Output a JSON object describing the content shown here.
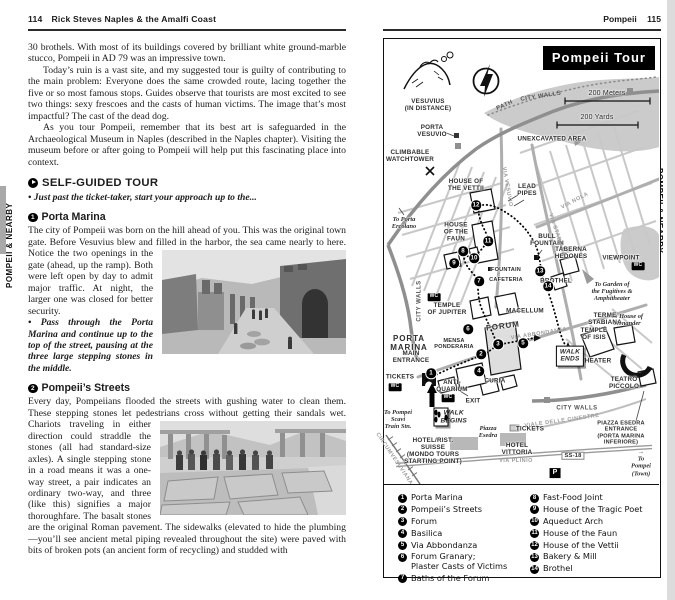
{
  "left_page": {
    "tab": "POMPEII & NEARBY",
    "page_number": "114",
    "book_title": "Rick Steves Naples & the Amalfi Coast",
    "para1": "30 brothels. With most of its buildings covered by brilliant white ground-marble stucco, Pompeii in AD 79 was an impressive town.",
    "para2": "Today’s ruin is a vast site, and my suggested tour is guilty of contributing to the main problem: Everyone does the same crowded route, lacing together the five or so most famous stops. Guides observe that tourists are most excited to see two things: sexy frescoes and the casts of human victims. The image that’s most impactful? The cast of the dead dog.",
    "para3": "As you tour Pompeii, remember that its best art is safeguarded in the Archaeological Museum in Naples (described in the Naples chapter). Visiting the museum before or after going to Pompeii will help put this fascinating place into context.",
    "tour_heading": "SELF-GUIDED TOUR",
    "tour_intro": "• Just past the ticket-taker, start your approach up to the...",
    "s1_num": "1",
    "s1_title": "Porta Marina",
    "s1_body": "The city of Pompeii was born on the hill ahead of you. This was the original town gate. Before Vesuvius blew and filled in the harbor, the sea came nearly to here. Notice the two openings in the gate (ahead, up the ramp). Both were left open by day to admit major traffic. At night, the larger one was closed for better security.",
    "s1_note": "• Pass through the Porta Marina and continue up to the top of the street, pausing at the three large stepping stones in the middle.",
    "s2_num": "2",
    "s2_title": "Pompeii’s Streets",
    "s2_body": "Every day, Pompeiians flooded the streets with gushing water to clean them. These stepping stones let pedestrians cross without getting their sandals wet. Chariots traveling in either direction could straddle the stones (all had standard-size axles). A single stepping stone in a road means it was a one-way street, a pair indicates an ordinary two-way, and three (like this) signifies a major thoroughfare. The basalt stones are the original Roman pavement. The sidewalks (elevated to hide the plumbing—you’ll see ancient metal piping revealed throughout the site) were paved with bits of broken pots (an ancient form of recycling) and studded with"
  },
  "right_page": {
    "tab": "POMPEII & NEARBY",
    "section_title": "Pompeii",
    "page_number": "115",
    "map": {
      "title": "Pompeii Tour",
      "labels": [
        {
          "id": "vesuvius",
          "cls": "",
          "lines": [
            "VESUVIUS",
            "(IN DISTANCE)"
          ]
        },
        {
          "id": "path",
          "cls": "street dk",
          "lines": [
            "PATH"
          ]
        },
        {
          "id": "city-walls-top",
          "cls": "street dk",
          "lines": [
            "CITY WALLS"
          ]
        },
        {
          "id": "scale-meters",
          "cls": "scale",
          "lines": [
            "200 Meters"
          ]
        },
        {
          "id": "scale-yards",
          "cls": "scale",
          "lines": [
            "200 Yards"
          ]
        },
        {
          "id": "unexcavated",
          "cls": "",
          "lines": [
            "UNEXCAVATED AREA"
          ]
        },
        {
          "id": "porta-vesuvio",
          "cls": "",
          "lines": [
            "PORTA",
            "VESUVIO"
          ]
        },
        {
          "id": "climbable-watchtower",
          "cls": "",
          "lines": [
            "CLIMBABLE",
            "WATCHTOWER"
          ]
        },
        {
          "id": "house-of-the-vettii",
          "cls": "",
          "lines": [
            "HOUSE OF",
            "THE VETTII"
          ]
        },
        {
          "id": "lead-pipes",
          "cls": "",
          "lines": [
            "LEAD",
            "PIPES"
          ]
        },
        {
          "id": "to-porta-ercolano",
          "cls": "it",
          "lines": [
            "To Porta",
            "Ercolano"
          ]
        },
        {
          "id": "house-of-the-faun",
          "cls": "",
          "lines": [
            "HOUSE",
            "OF THE",
            "FAUN"
          ]
        },
        {
          "id": "bull-fountain",
          "cls": "",
          "lines": [
            "BULL",
            "FOUNTAIN"
          ]
        },
        {
          "id": "taberna-hedones",
          "cls": "",
          "lines": [
            "TABERNA",
            "HEDONES"
          ]
        },
        {
          "id": "viewpoint",
          "cls": "",
          "lines": [
            "VIEWPOINT"
          ]
        },
        {
          "id": "wc-viewpoint",
          "cls": "wc",
          "lines": [
            "WC"
          ]
        },
        {
          "id": "to-garden",
          "cls": "it",
          "lines": [
            "To Garden of",
            "the Fugitives &",
            "Amphitheater"
          ]
        },
        {
          "id": "brothel",
          "cls": "",
          "lines": [
            "BROTHEL"
          ]
        },
        {
          "id": "to-menander",
          "cls": "it",
          "lines": [
            "To House of",
            "Menander"
          ]
        },
        {
          "id": "terme-stabiana",
          "cls": "",
          "lines": [
            "TERME",
            "STABIANA"
          ]
        },
        {
          "id": "temple-of-isis",
          "cls": "",
          "lines": [
            "TEMPLE",
            "OF ISIS"
          ]
        },
        {
          "id": "theater",
          "cls": "",
          "lines": [
            "THEATER"
          ]
        },
        {
          "id": "teatro-piccolo",
          "cls": "",
          "lines": [
            "TEATRO",
            "PICCOLO"
          ]
        },
        {
          "id": "walk-ends",
          "cls": "box",
          "lines": [
            "WALK",
            "ENDS"
          ]
        },
        {
          "id": "city-walls-left",
          "cls": "street dk",
          "lines": [
            "CITY WALLS"
          ]
        },
        {
          "id": "temple-of-jupiter",
          "cls": "",
          "lines": [
            "TEMPLE",
            "OF JUPITER"
          ]
        },
        {
          "id": "macellum",
          "cls": "",
          "lines": [
            "MACELLUM"
          ]
        },
        {
          "id": "forum",
          "cls": "big",
          "lines": [
            "FORUM"
          ]
        },
        {
          "id": "mensa-ponderaria",
          "cls": "sm",
          "lines": [
            "MENSA",
            "PONDERARIA"
          ]
        },
        {
          "id": "fountain",
          "cls": "sm",
          "lines": [
            "FOUNTAIN"
          ]
        },
        {
          "id": "cafeteria",
          "cls": "sm",
          "lines": [
            "CAFETERIA"
          ]
        },
        {
          "id": "via-abbondanza",
          "cls": "street",
          "lines": [
            "VIA ABBONDANZA"
          ]
        },
        {
          "id": "curia",
          "cls": "",
          "lines": [
            "CURIA"
          ]
        },
        {
          "id": "porta-marina",
          "cls": "big",
          "lines": [
            "PORTA",
            "MARINA"
          ]
        },
        {
          "id": "main-entrance",
          "cls": "",
          "lines": [
            "MAIN",
            "ENTRANCE"
          ]
        },
        {
          "id": "tickets-west",
          "cls": "",
          "lines": [
            "TICKETS"
          ]
        },
        {
          "id": "wc-tickets",
          "cls": "wc",
          "lines": [
            "WC"
          ]
        },
        {
          "id": "antiquarium",
          "cls": "",
          "lines": [
            "ANTI-",
            "QUARIUM"
          ]
        },
        {
          "id": "wc-antiquarium",
          "cls": "wc",
          "lines": [
            "WC"
          ]
        },
        {
          "id": "wc-forum",
          "cls": "wc",
          "lines": [
            "WC"
          ]
        },
        {
          "id": "exit",
          "cls": "",
          "lines": [
            "EXIT"
          ]
        },
        {
          "id": "to-train",
          "cls": "it",
          "lines": [
            "To Pompei",
            "Scavi",
            "Train Stn."
          ]
        },
        {
          "id": "walk-begins",
          "cls": "box feet",
          "lines": [
            "WALK",
            "BEGINS"
          ]
        },
        {
          "id": "piazza-esedra",
          "cls": "it med",
          "lines": [
            "Piazza",
            "Esedra"
          ]
        },
        {
          "id": "tickets-east",
          "cls": "",
          "lines": [
            "TICKETS"
          ]
        },
        {
          "id": "hotel-suisse",
          "cls": "",
          "lines": [
            "HOTEL/RIST.",
            "SUISSE",
            "(MONDO TOURS",
            "STARTING POINT)"
          ]
        },
        {
          "id": "hotel-vittoria",
          "cls": "",
          "lines": [
            "HOTEL",
            "VITTORIA"
          ]
        },
        {
          "id": "via-plinio",
          "cls": "street",
          "lines": [
            "VIA PLINIO"
          ]
        },
        {
          "id": "ss-18",
          "cls": "badge",
          "lines": [
            "SS-18"
          ]
        },
        {
          "id": "to-pompei-town",
          "cls": "it sm2",
          "lines": [
            "→",
            "To",
            "Pompei",
            "(Town)"
          ]
        },
        {
          "id": "parking",
          "cls": "pbadge",
          "lines": [
            "P"
          ]
        },
        {
          "id": "piazza-esedra-entrance",
          "cls": "sm",
          "lines": [
            "PIAZZA ESEDRA",
            "ENTRANCE",
            "(PORTA MARINA",
            "INFERIORE)"
          ]
        },
        {
          "id": "city-walls-bottom",
          "cls": "street dk",
          "lines": [
            "CITY WALLS"
          ]
        },
        {
          "id": "viale-delle-ginestre",
          "cls": "street",
          "lines": [
            "VIALE DELLE GINESTRE"
          ]
        },
        {
          "id": "circumvesuviana",
          "cls": "street",
          "lines": [
            "CIRCUMVESUVIANA"
          ]
        },
        {
          "id": "via-stabiana",
          "cls": "street",
          "lines": [
            "VIA STABIANA"
          ]
        },
        {
          "id": "via-vesuvio",
          "cls": "street",
          "lines": [
            "VIA VESUVIO"
          ]
        },
        {
          "id": "via-nola",
          "cls": "street",
          "lines": [
            "VIA NOLA"
          ]
        }
      ]
    },
    "legend": {
      "left": [
        {
          "n": "1",
          "label": "Porta Marina"
        },
        {
          "n": "2",
          "label": "Pompeii’s Streets"
        },
        {
          "n": "3",
          "label": "Forum"
        },
        {
          "n": "4",
          "label": "Basilica"
        },
        {
          "n": "5",
          "label": "Via Abbondanza"
        },
        {
          "n": "6",
          "label": "Forum Granary;\nPlaster Casts of Victims"
        },
        {
          "n": "7",
          "label": "Baths of the Forum"
        }
      ],
      "right": [
        {
          "n": "8",
          "label": "Fast-Food Joint"
        },
        {
          "n": "9",
          "label": "House of the Tragic Poet"
        },
        {
          "n": "10",
          "label": "Aqueduct Arch"
        },
        {
          "n": "11",
          "label": "House of the Faun"
        },
        {
          "n": "12",
          "label": "House of the Vettii"
        },
        {
          "n": "13",
          "label": "Bakery & Mill"
        },
        {
          "n": "14",
          "label": "Brothel"
        }
      ]
    }
  }
}
